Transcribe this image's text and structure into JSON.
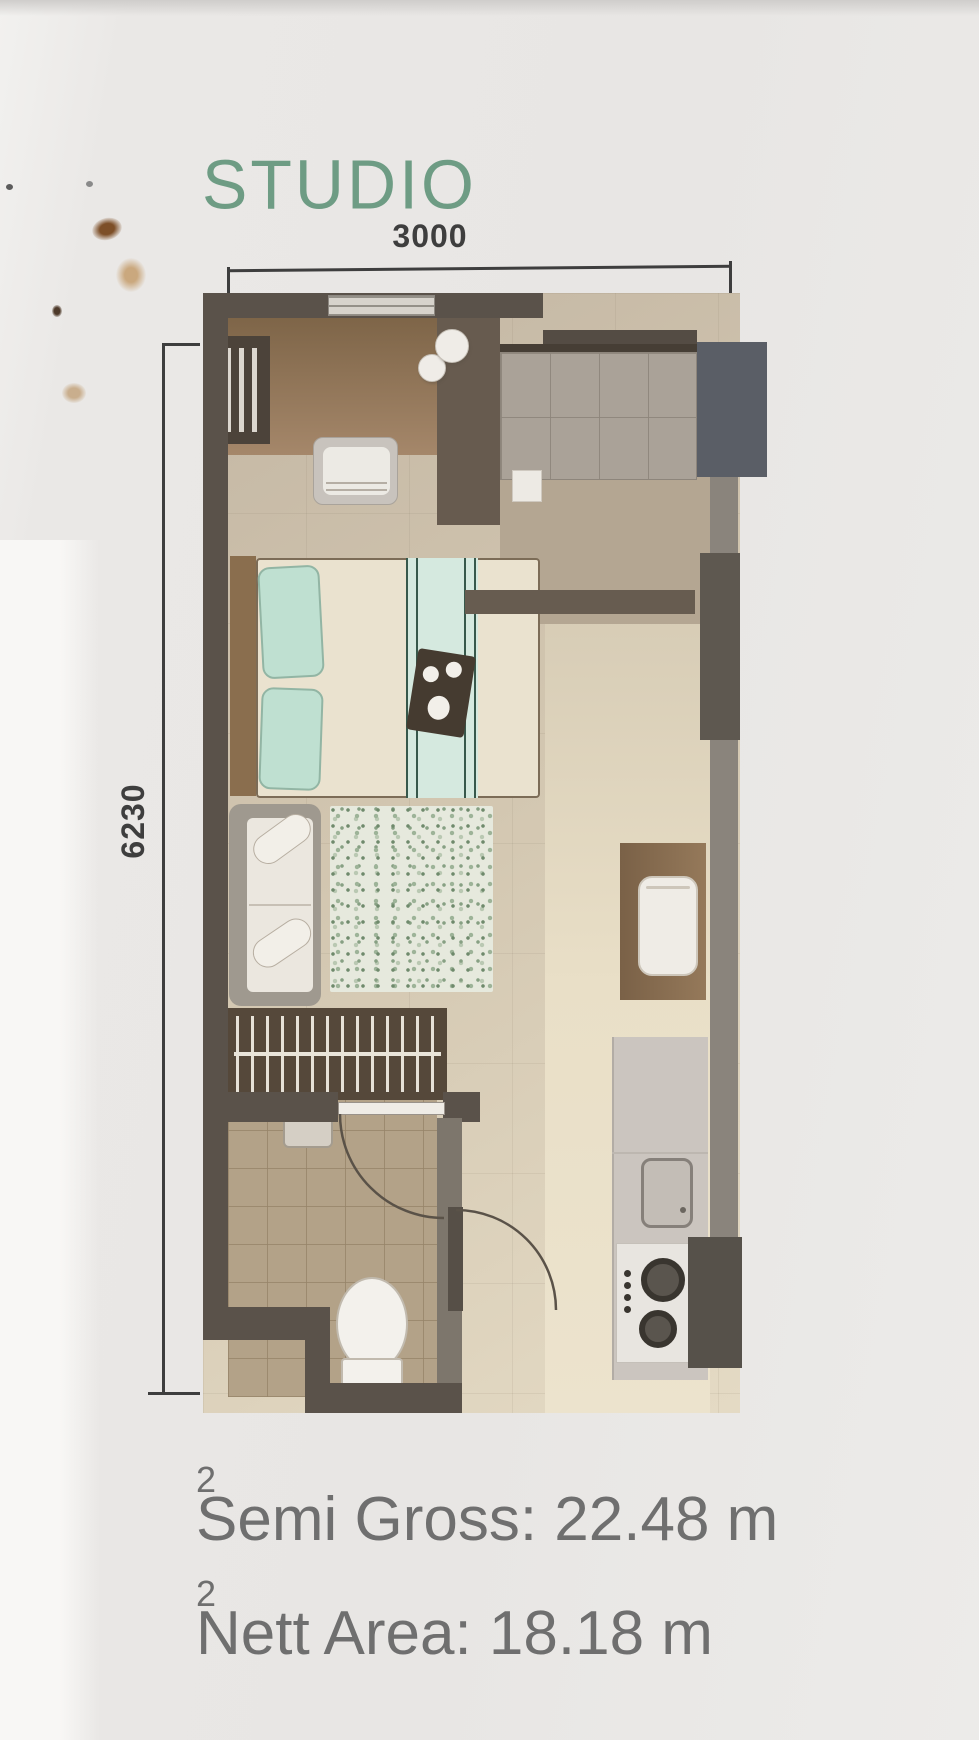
{
  "header": {
    "title": "STUDIO",
    "title_color": "#6e9c84"
  },
  "dimensions": {
    "width_mm": "3000",
    "height_mm": "6230",
    "ink_color": "#3e3e3e"
  },
  "footer": {
    "lines": [
      {
        "text": "Semi Gross: 22.48 m",
        "sup": "2"
      },
      {
        "text": "Nett Area: 18.18 m",
        "sup": "2"
      }
    ],
    "text_color": "#6f6f6f"
  },
  "palette": {
    "wall": "#5a524a",
    "floor_beige": "#d2c6b0",
    "bathroom_tile": "#b3a288",
    "entry_floor": "#b4a692",
    "pillow_teal": "#bfe0d1",
    "rug_green": "#87a083",
    "shaft_navy": "#5a5e66"
  }
}
